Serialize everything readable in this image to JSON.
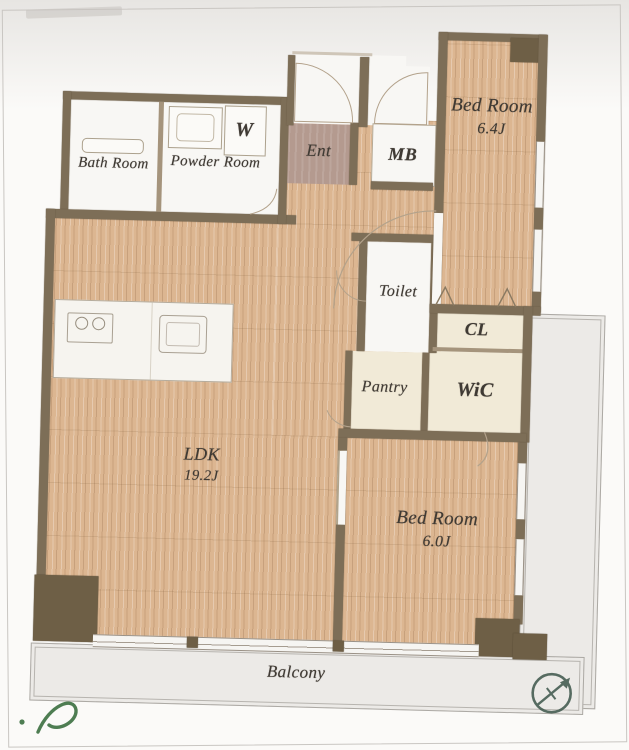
{
  "plan": {
    "type": "apartment-floor-plan",
    "rooms": {
      "bath": {
        "label": "Bath Room"
      },
      "powder": {
        "label": "Powder Room"
      },
      "washer": {
        "label": "W"
      },
      "entrance": {
        "label": "Ent"
      },
      "meter_box": {
        "label": "MB"
      },
      "bedroom_1": {
        "label": "Bed Room",
        "size": "6.4J"
      },
      "toilet": {
        "label": "Toilet"
      },
      "closet": {
        "label": "CL"
      },
      "pantry": {
        "label": "Pantry"
      },
      "walk_in_closet": {
        "label": "WiC"
      },
      "ldk": {
        "label": "LDK",
        "size": "19.2J"
      },
      "bedroom_2": {
        "label": "Bed Room",
        "size": "6.0J"
      },
      "balcony": {
        "label": "Balcony"
      }
    },
    "icons": [
      "compass-icon",
      "stove-icon",
      "sink-icon",
      "bathtub-icon",
      "washbasin-icon",
      "signature-mark"
    ],
    "colors": {
      "wood_floor": "#dcb691",
      "wall": "#7d6e57",
      "pillar": "#6e5f46",
      "white_room": "#f8f7f4",
      "cream_room": "#f1ead7",
      "entrance_floor": "#b49a8f",
      "balcony": "#eceae7",
      "label_text": "#3f3a34",
      "compass": "#3d564a",
      "signature": "#4e7d52"
    }
  }
}
